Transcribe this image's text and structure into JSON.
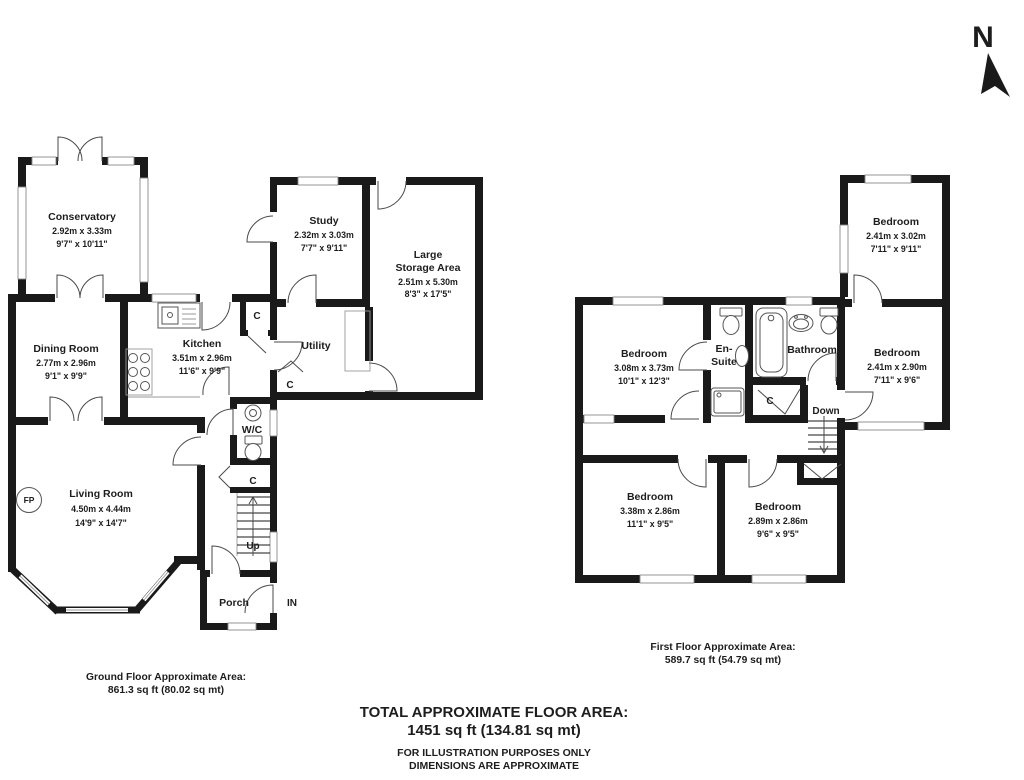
{
  "compass": {
    "label": "N"
  },
  "ground": {
    "rooms": {
      "conservatory": {
        "name": "Conservatory",
        "metric": "2.92m x 3.33m",
        "imperial": "9'7\" x 10'11\""
      },
      "dining_room": {
        "name": "Dining Room",
        "metric": "2.77m x 2.96m",
        "imperial": "9'1\" x 9'9\""
      },
      "kitchen": {
        "name": "Kitchen",
        "metric": "3.51m x 2.96m",
        "imperial": "11'6\" x 9'9\""
      },
      "study": {
        "name": "Study",
        "metric": "2.32m x 3.03m",
        "imperial": "7'7\" x 9'11\""
      },
      "storage": {
        "line1": "Large",
        "line2": "Storage Area",
        "metric": "2.51m x 5.30m",
        "imperial": "8'3\" x 17'5\""
      },
      "utility": {
        "name": "Utility"
      },
      "wc": {
        "name": "W/C"
      },
      "living_room": {
        "name": "Living Room",
        "metric": "4.50m x 4.44m",
        "imperial": "14'9\" x 14'7\""
      },
      "porch": {
        "name": "Porch"
      }
    },
    "markers": {
      "up": "Up",
      "in_door": "IN",
      "fireplace": "FP",
      "cupboard": "C"
    },
    "area_label": "Ground Floor Approximate Area:",
    "area_value": "861.3 sq ft (80.02 sq mt)"
  },
  "first": {
    "rooms": {
      "bedroom_top_right": {
        "name": "Bedroom",
        "metric": "2.41m x 3.02m",
        "imperial": "7'11\" x 9'11\""
      },
      "bedroom_left": {
        "name": "Bedroom",
        "metric": "3.08m x 3.73m",
        "imperial": "10'1\" x 12'3\""
      },
      "ensuite": {
        "line1": "En-",
        "line2": "Suite"
      },
      "bathroom": {
        "name": "Bathroom"
      },
      "bedroom_right": {
        "name": "Bedroom",
        "metric": "2.41m x 2.90m",
        "imperial": "7'11\" x 9'6\""
      },
      "bedroom_bottom_left": {
        "name": "Bedroom",
        "metric": "3.38m x 2.86m",
        "imperial": "11'1\" x 9'5\""
      },
      "bedroom_bottom_right": {
        "name": "Bedroom",
        "metric": "2.89m x 2.86m",
        "imperial": "9'6\" x 9'5\""
      }
    },
    "markers": {
      "down": "Down",
      "cupboard": "C"
    },
    "area_label": "First Floor Approximate Area:",
    "area_value": "589.7 sq ft (54.79 sq mt)"
  },
  "footer": {
    "total_label": "TOTAL APPROXIMATE FLOOR AREA:",
    "total_value": "1451 sq ft (134.81 sq mt)",
    "disclaimer1": "FOR ILLUSTRATION PURPOSES ONLY",
    "disclaimer2": "DIMENSIONS ARE APPROXIMATE"
  }
}
